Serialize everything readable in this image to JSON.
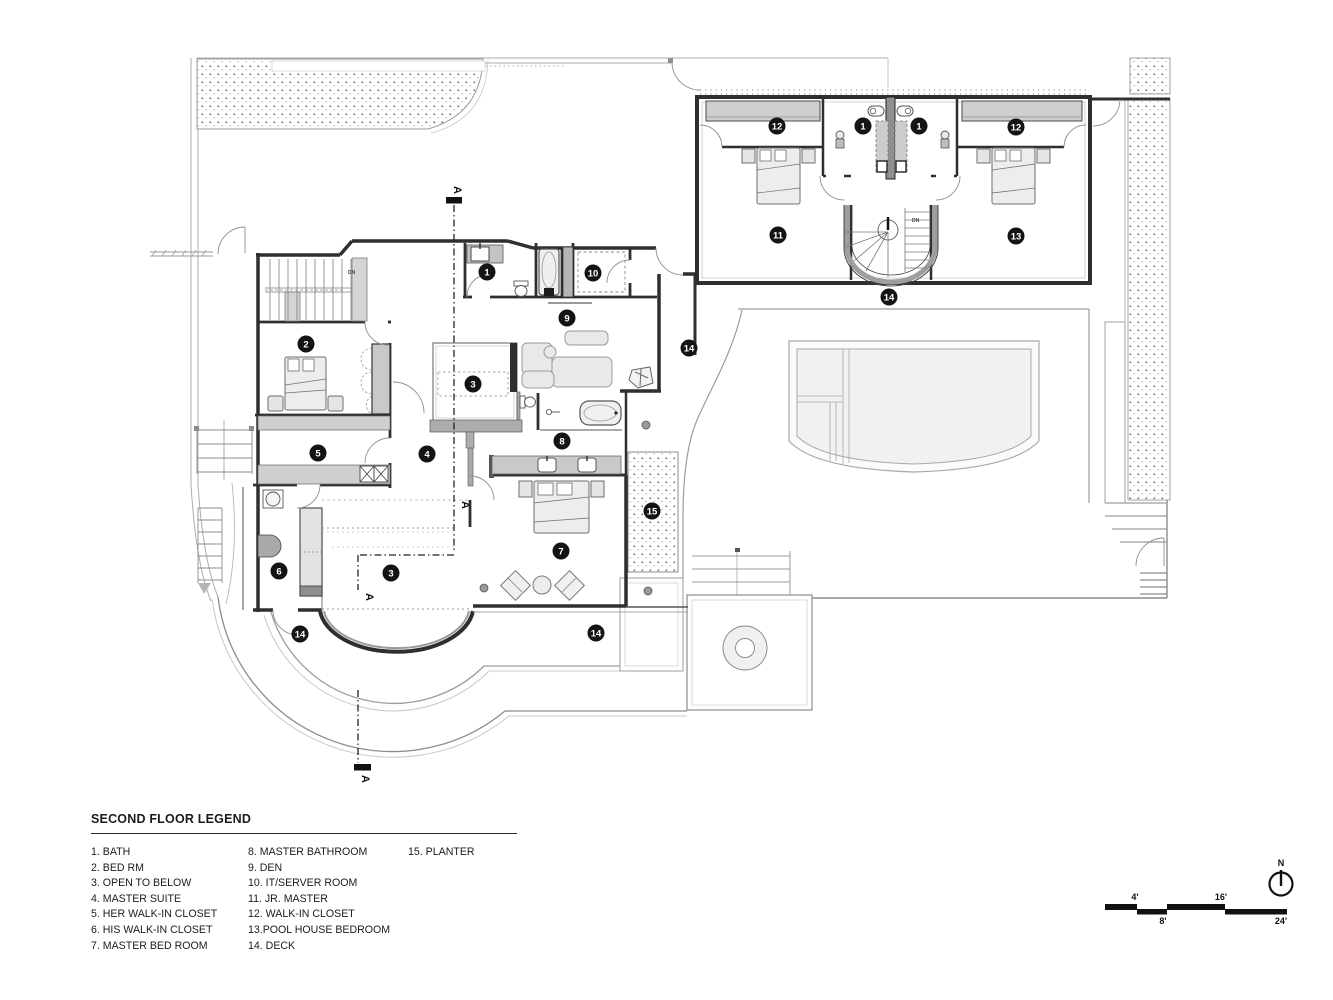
{
  "legend": {
    "title": "SECOND FLOOR LEGEND",
    "columns": [
      [
        "1. BATH",
        "2. BED RM",
        "3. OPEN TO BELOW",
        "4. MASTER SUITE",
        "5. HER WALK-IN CLOSET",
        "6. HIS WALK-IN CLOSET",
        "7. MASTER BED ROOM"
      ],
      [
        "8. MASTER BATHROOM",
        "9. DEN",
        "10. IT/SERVER ROOM",
        "11. JR. MASTER",
        "12. WALK-IN CLOSET",
        "13.POOL HOUSE BEDROOM",
        "14. DECK"
      ],
      [
        "15. PLANTER"
      ]
    ]
  },
  "plan": {
    "markers": [
      {
        "n": "1",
        "x": 487,
        "y": 272
      },
      {
        "n": "1",
        "x": 863,
        "y": 126
      },
      {
        "n": "1",
        "x": 919,
        "y": 126
      },
      {
        "n": "2",
        "x": 306,
        "y": 344
      },
      {
        "n": "3",
        "x": 473,
        "y": 384
      },
      {
        "n": "3",
        "x": 391,
        "y": 573
      },
      {
        "n": "4",
        "x": 427,
        "y": 454
      },
      {
        "n": "5",
        "x": 318,
        "y": 453
      },
      {
        "n": "6",
        "x": 279,
        "y": 571
      },
      {
        "n": "7",
        "x": 561,
        "y": 551
      },
      {
        "n": "8",
        "x": 562,
        "y": 441
      },
      {
        "n": "9",
        "x": 567,
        "y": 318
      },
      {
        "n": "10",
        "x": 593,
        "y": 273
      },
      {
        "n": "11",
        "x": 778,
        "y": 235
      },
      {
        "n": "12",
        "x": 777,
        "y": 126
      },
      {
        "n": "12",
        "x": 1016,
        "y": 127
      },
      {
        "n": "13",
        "x": 1016,
        "y": 236
      },
      {
        "n": "14",
        "x": 889,
        "y": 297
      },
      {
        "n": "14",
        "x": 689,
        "y": 348
      },
      {
        "n": "14",
        "x": 300,
        "y": 634
      },
      {
        "n": "14",
        "x": 596,
        "y": 633
      },
      {
        "n": "15",
        "x": 652,
        "y": 511
      }
    ],
    "section_letters": [
      {
        "t": "A",
        "x": 454,
        "y": 190
      },
      {
        "t": "A",
        "x": 462,
        "y": 505
      },
      {
        "t": "A",
        "x": 366,
        "y": 597
      },
      {
        "t": "A",
        "x": 362,
        "y": 779
      }
    ],
    "stair_labels": [
      {
        "t": "DN",
        "x": 348,
        "y": 274
      },
      {
        "t": "DN",
        "x": 912,
        "y": 222
      }
    ]
  },
  "scale_bar": {
    "labels": [
      "4'",
      "8'",
      "16'",
      "24'"
    ]
  },
  "north": {
    "label": "N"
  },
  "colors": {
    "wall": "#2f2f2f",
    "marker": "#141414",
    "site": "#adadad"
  }
}
